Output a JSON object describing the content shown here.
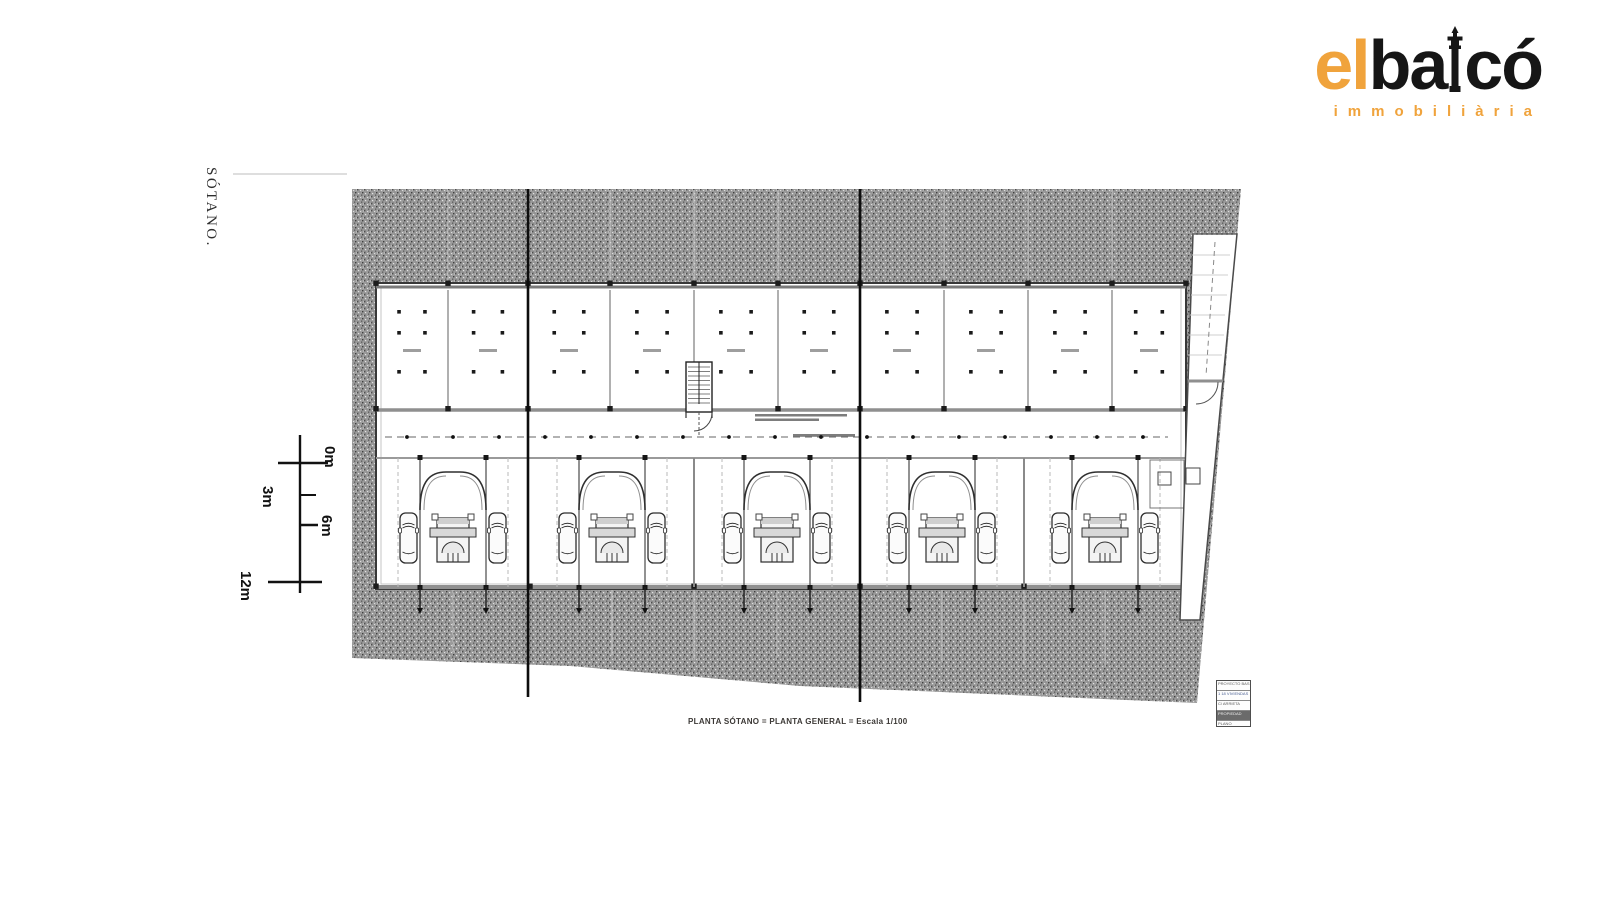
{
  "brand": {
    "prefix": "el",
    "word_a": "ba",
    "word_b": "có",
    "tagline": "immobiliària",
    "accent_color": "#F0A33C",
    "ink_color": "#161616"
  },
  "drawing": {
    "side_label": "SÓTANO.",
    "caption": "PLANTA SÓTANO = PLANTA GENERAL = Escala 1/100",
    "scale_bar": {
      "labels": [
        "0m",
        "3m",
        "6m",
        "12m"
      ]
    },
    "title_block": {
      "rows": [
        "PROYECTO BAS",
        "1 18 VIVIENDAS",
        "C/ ARRIETA",
        "PROPIEDAD",
        "PLANO"
      ]
    }
  }
}
